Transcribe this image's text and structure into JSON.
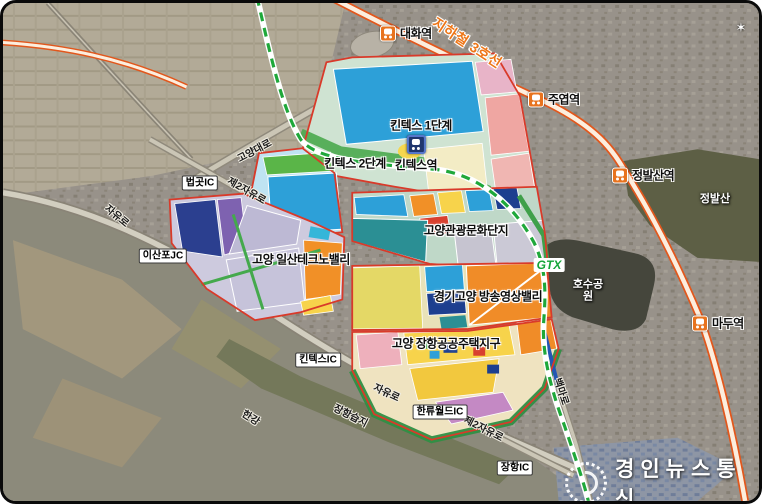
{
  "watermark": {
    "text": "경인뉴스통신"
  },
  "transit": {
    "line3_label": "지하철 3호선",
    "gtx_label": "GTX",
    "stations": {
      "daehwa": "대화역",
      "juyeop": "주엽역",
      "jeongbalsan": "정발산역",
      "madu": "마두역",
      "kintex": "킨텍스역"
    }
  },
  "zones": {
    "kintex1": "킨텍스 1단계",
    "kintex2": "킨텍스 2단계",
    "tourism": "고양관광문화단지",
    "technovalley": "고양 일산테크노밸리",
    "media": "경기고양 방송영상밸리",
    "janghang_housing": "고양 장항공공주택지구"
  },
  "roads": {
    "jayuro": "자유로",
    "jayuro2": "제2자유로",
    "goyangdaero": "고양대로",
    "baengmaro": "백마로"
  },
  "interchanges": {
    "beopgot": "법곳IC",
    "isanpo": "이산포JC",
    "kintex": "킨텍스IC",
    "hallyuworld": "한류월드IC",
    "janghang": "장항IC"
  },
  "places": {
    "lake_park": "호수공원",
    "jeongbalsan": "정발산",
    "hangang": "한강",
    "janghang_wetland": "장항습지"
  },
  "colors": {
    "line3_orange": "#e2571c",
    "gtx_green": "#1fa83a",
    "zone_boundary_red": "#d93a2a",
    "kintex_blue": "#2da0d8"
  }
}
